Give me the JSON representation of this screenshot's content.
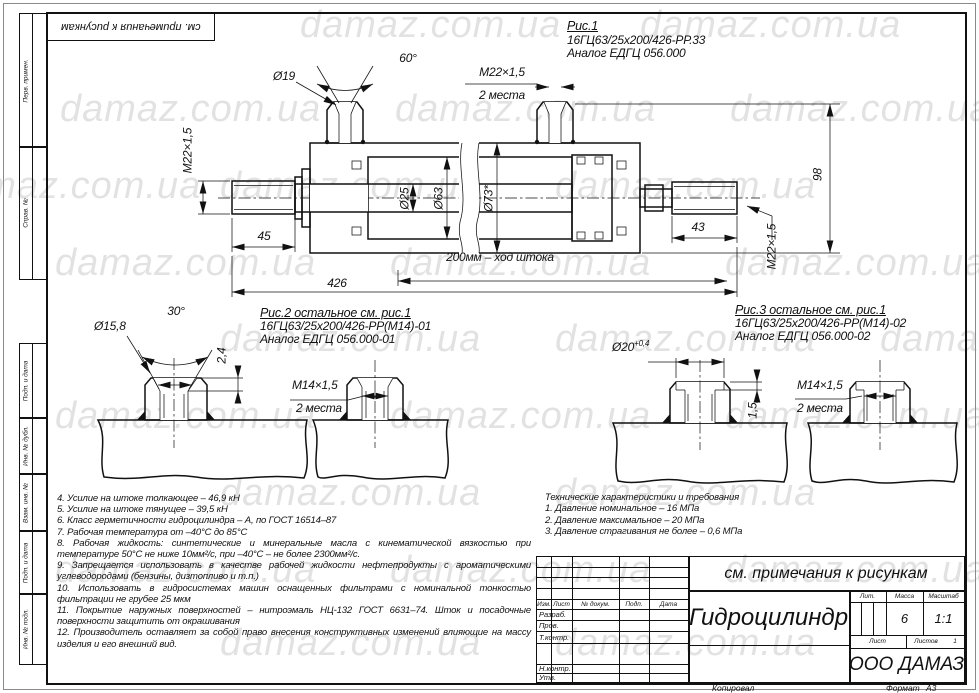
{
  "watermark": {
    "text": "damaz.com.ua"
  },
  "sheet": {
    "corner_note": "см. примечания к рисункам",
    "copied_label": "Копировал",
    "format_label": "Формат",
    "format_value": "А3"
  },
  "margin": {
    "perv_primen": "Перв. примен.",
    "sprav_no": "Справ. №",
    "podp_data1": "Подп. и дата",
    "inv_dubl": "Инв. № дубл.",
    "vzam_inv": "Взам. инв. №",
    "podp_data2": "Подп. и дата",
    "inv_podl": "Инв. № подл."
  },
  "fig1": {
    "title": "Рис.1",
    "model": "16ГЦ63/25x200/426-РР.33",
    "analog": "Аналог ЕДГЦ 056.000",
    "dims": {
      "port_dia": "Ø19",
      "cone_angle": "60°",
      "port_thread": "M22×1,5",
      "port_places": "2 места",
      "rod_thread_left": "M22×1,5",
      "rod_dia": "Ø25",
      "bore_dia": "Ø63",
      "outer_dia": "Ø73*",
      "height": "98",
      "rod_len_left": "45",
      "rod_len_right": "43",
      "rod_thread_right": "M22×1,5",
      "total_length": "426",
      "stroke": "200мм – ход штока"
    }
  },
  "fig2": {
    "title": "Рис.2 остальное см. рис.1",
    "model": "16ГЦ63/25x200/426-РР(М14)-01",
    "analog": "Аналог ЕДГЦ 056.000-01",
    "dims": {
      "hole_dia": "Ø15,8",
      "cone_angle": "30°",
      "depth": "2,4",
      "thread": "M14×1,5",
      "places": "2 места"
    }
  },
  "fig3": {
    "title": "Рис.3 остальное см. рис.1",
    "model": "16ГЦ63/25x200/426-РР(М14)-02",
    "analog": "Аналог ЕДГЦ 056.000-02",
    "dims": {
      "bore_dia": "Ø20",
      "bore_tol": "+0,4",
      "depth": "1,5",
      "thread": "M14×1,5",
      "places": "2 места"
    }
  },
  "notes": [
    "4.   Усилие на штоке толкающее – 46,9 кН",
    "5.   Усилие на штоке тянущее – 39,5 кН",
    "6.   Класс герметичности гидроцилиндра – А, по ГОСТ 16514–87",
    "7.   Рабочая температура от –40°С до 85°С",
    "8.   Рабочая жидкость: синтетические и минеральные масла с кинематической вязкостью при температуре 50°С не ниже 10мм²/с, при –40°С – не более 2300мм²/с.",
    "9.   Запрещается использовать в качестве рабочей жидкости нефтепродукты с ароматическими углеводородами (бензины, дизтопливо и т.п.)",
    "10.  Использовать в гидросистемах машин оснащенных фильтрами с номинальной тонкостью фильтрации не грубее 25 мкм",
    "11.  Покрытие наружных поверхностей – нитроэмаль НЦ-132 ГОСТ 6631–74. Шток и посадочные поверхности защитить от окрашивания",
    "12.  Производитель оставляет за собой право внесения конструктивных изменений влияющие на массу изделия и его внешний вид."
  ],
  "specs": {
    "title": "Технические характеристики и требования",
    "items": [
      "1.  Давление номинальное – 16 МПа",
      "2.  Давление максимальное – 20 МПа",
      "3.  Давление страгивания не более – 0,6 МПа"
    ]
  },
  "title_block": {
    "note": "см. примечания к рисункам",
    "doc_name": "Гидроцилиндр",
    "cols": {
      "izm": "Изм.",
      "list": "Лист",
      "doc": "№ докум.",
      "podp": "Подп.",
      "data": "Дата"
    },
    "rows": {
      "razrab": "Разраб.",
      "prov": "Пров.",
      "tkontr": "Т.контр.",
      "nkontr": "Н.контр.",
      "utv": "Утв."
    },
    "lit_label": "Лит.",
    "mass_label": "Масса",
    "scale_label": "Масштаб",
    "mass_value": "6",
    "scale_value": "1:1",
    "sheet_label": "Лист",
    "sheets_label": "Листов",
    "sheets_value": "1",
    "company": "ООО ДАМАЗ"
  }
}
